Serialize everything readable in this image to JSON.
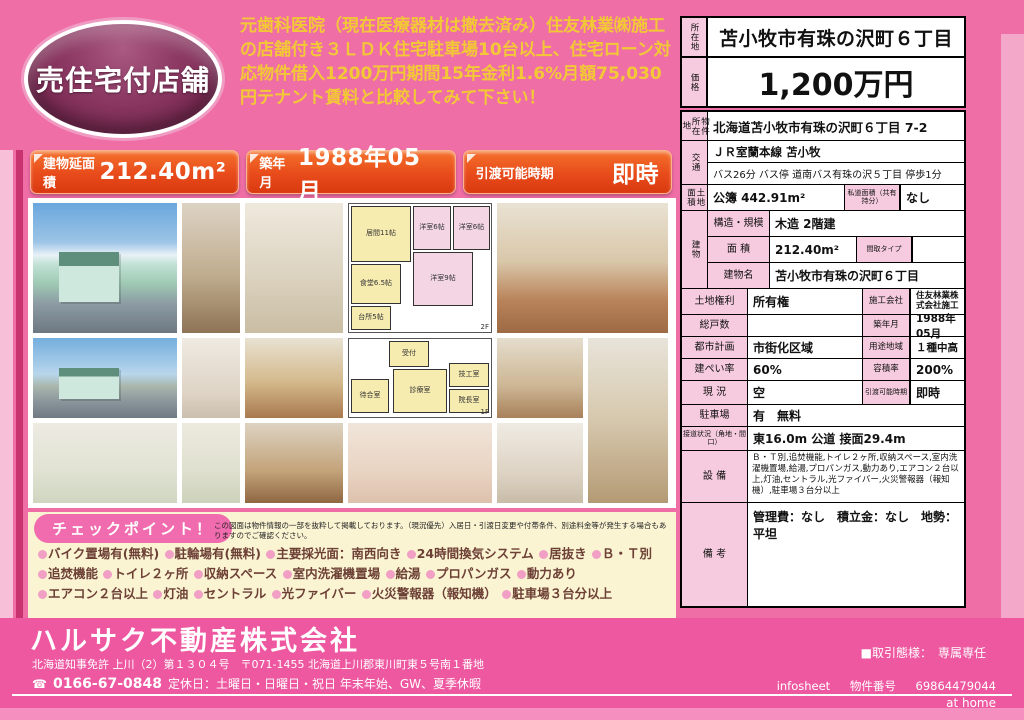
{
  "colors": {
    "background_pink": "#f06ea6",
    "footer_pink": "#ee58a0",
    "accent_orange": "#e8491d",
    "badge_maroon": "#7c2250",
    "headline_yellow": "#f2c837",
    "checkpoint_bg": "#fbf4d3",
    "table_label_pink": "#f6cbdf"
  },
  "badge": {
    "label": "売住宅付店舗"
  },
  "headline": "元歯科医院（現在医療器材は撤去済み）住友林業㈱施工の店舗付き３ＬＤＫ住宅駐車場10台以上、住宅ローン対応物件借入1200万円期間15年金利1.6%月額75,030円テナント賃料と比較してみて下さい！",
  "banners": [
    {
      "label": "建物延面積",
      "value": "212.40m²"
    },
    {
      "label": "築年月",
      "value": "1988年05月"
    },
    {
      "label": "引渡可能時期",
      "value": "即時"
    }
  ],
  "summary": {
    "location_label": "所在地",
    "location": "苫小牧市有珠の沢町６丁目",
    "price_label": "価格",
    "price": "1,200万円"
  },
  "details": {
    "address_label": "物件所在地",
    "address": "北海道苫小牧市有珠の沢町６丁目 7-2",
    "access_label": "交通",
    "access_line1": "ＪＲ室蘭本線 苫小牧",
    "access_line2": "バス26分 バス停 道南バス有珠の沢５丁目 停歩1分",
    "land_area_label": "土地面積",
    "land_area": "公簿 442.91m²",
    "private_road_label": "私道面積（共有持分）",
    "private_road": "なし",
    "building_label": "建物",
    "structure_label": "構造・規模",
    "structure": "木造 2階建",
    "floor_area_label": "面 積",
    "floor_area": "212.40m²",
    "plan_type_label": "間取タイプ",
    "plan_type": "",
    "building_name_label": "建物名",
    "building_name": "苫小牧市有珠の沢町６丁目",
    "land_rights_label": "土地権利",
    "land_rights": "所有権",
    "builder_label": "施工会社",
    "builder": "住友林業株式会社施工",
    "total_units_label": "総戸数",
    "total_units": "",
    "built_label": "築年月",
    "built": "1988年05月",
    "city_planning_label": "都市計画",
    "city_planning": "市街化区域",
    "zoning_label": "用途地域",
    "zoning": "１種中高",
    "coverage_label": "建ぺい率",
    "coverage": "60%",
    "floor_ratio_label": "容積率",
    "floor_ratio": "200%",
    "status_label": "現 況",
    "status": "空",
    "delivery_label": "引渡可能時期",
    "delivery": "即時",
    "parking_label": "駐車場",
    "parking": "有　無料",
    "road_label": "接道状況（角地・間口）",
    "road": "東16.0m 公道 接面29.4m",
    "equipment_label": "設 備",
    "equipment": "Ｂ・Ｔ別,追焚機能,トイレ２ヶ所,収納スペース,室内洗濯機置場,給湯,プロパンガス,動力あり,エアコン２台以上,灯油,セントラル,光ファイバー,火災警報器（報知機）,駐車場３台分以上",
    "notes_label": "備 考",
    "notes": "管理費：なし　積立金：なし　地勢：平坦"
  },
  "floorplan": {
    "f2": {
      "mark": "2F",
      "rooms": [
        "居間11帖",
        "洋室6帖",
        "洋室6帖",
        "食堂6.5帖",
        "洋室9帖",
        "台所5帖"
      ]
    },
    "f1": {
      "mark": "1F",
      "rooms": [
        "受付",
        "診療室",
        "院長室",
        "技工室",
        "待合室"
      ]
    }
  },
  "checkpoint": {
    "title": "チェックポイント！",
    "disclaimer": "この図面は物件情報の一部を抜粋して掲載しております。（現況優先）入居日・引渡日変更や付帯条件、別途料金等が発生する場合もありますのでご確認ください。",
    "features": [
      "バイク置場有(無料)",
      "駐輪場有(無料)",
      "主要採光面：南西向き",
      "24時間換気システム",
      "居抜き",
      "Ｂ・Ｔ別",
      "追焚機能",
      "トイレ２ヶ所",
      "収納スペース",
      "室内洗濯機置場",
      "給湯",
      "プロパンガス",
      "動力あり",
      "エアコン２台以上",
      "灯油",
      "セントラル",
      "光ファイバー",
      "火災警報器（報知機）",
      "駐車場３台分以上"
    ]
  },
  "footer": {
    "company": "ハルサク不動産株式会社",
    "license": "北海道知事免許 上川（2）第１３０４号　〒071-1455 北海道上川郡東川町東５号南１番地",
    "phone": "0166-67-0848",
    "holidays": "定休日：土曜日・日曜日・祝日 年末年始、GW、夏季休暇",
    "transaction": "■取引態様：　専属専任",
    "infosheet_label": "infosheet",
    "property_no_label": "物件番号",
    "property_no": "69864479044",
    "brand": "at home"
  }
}
